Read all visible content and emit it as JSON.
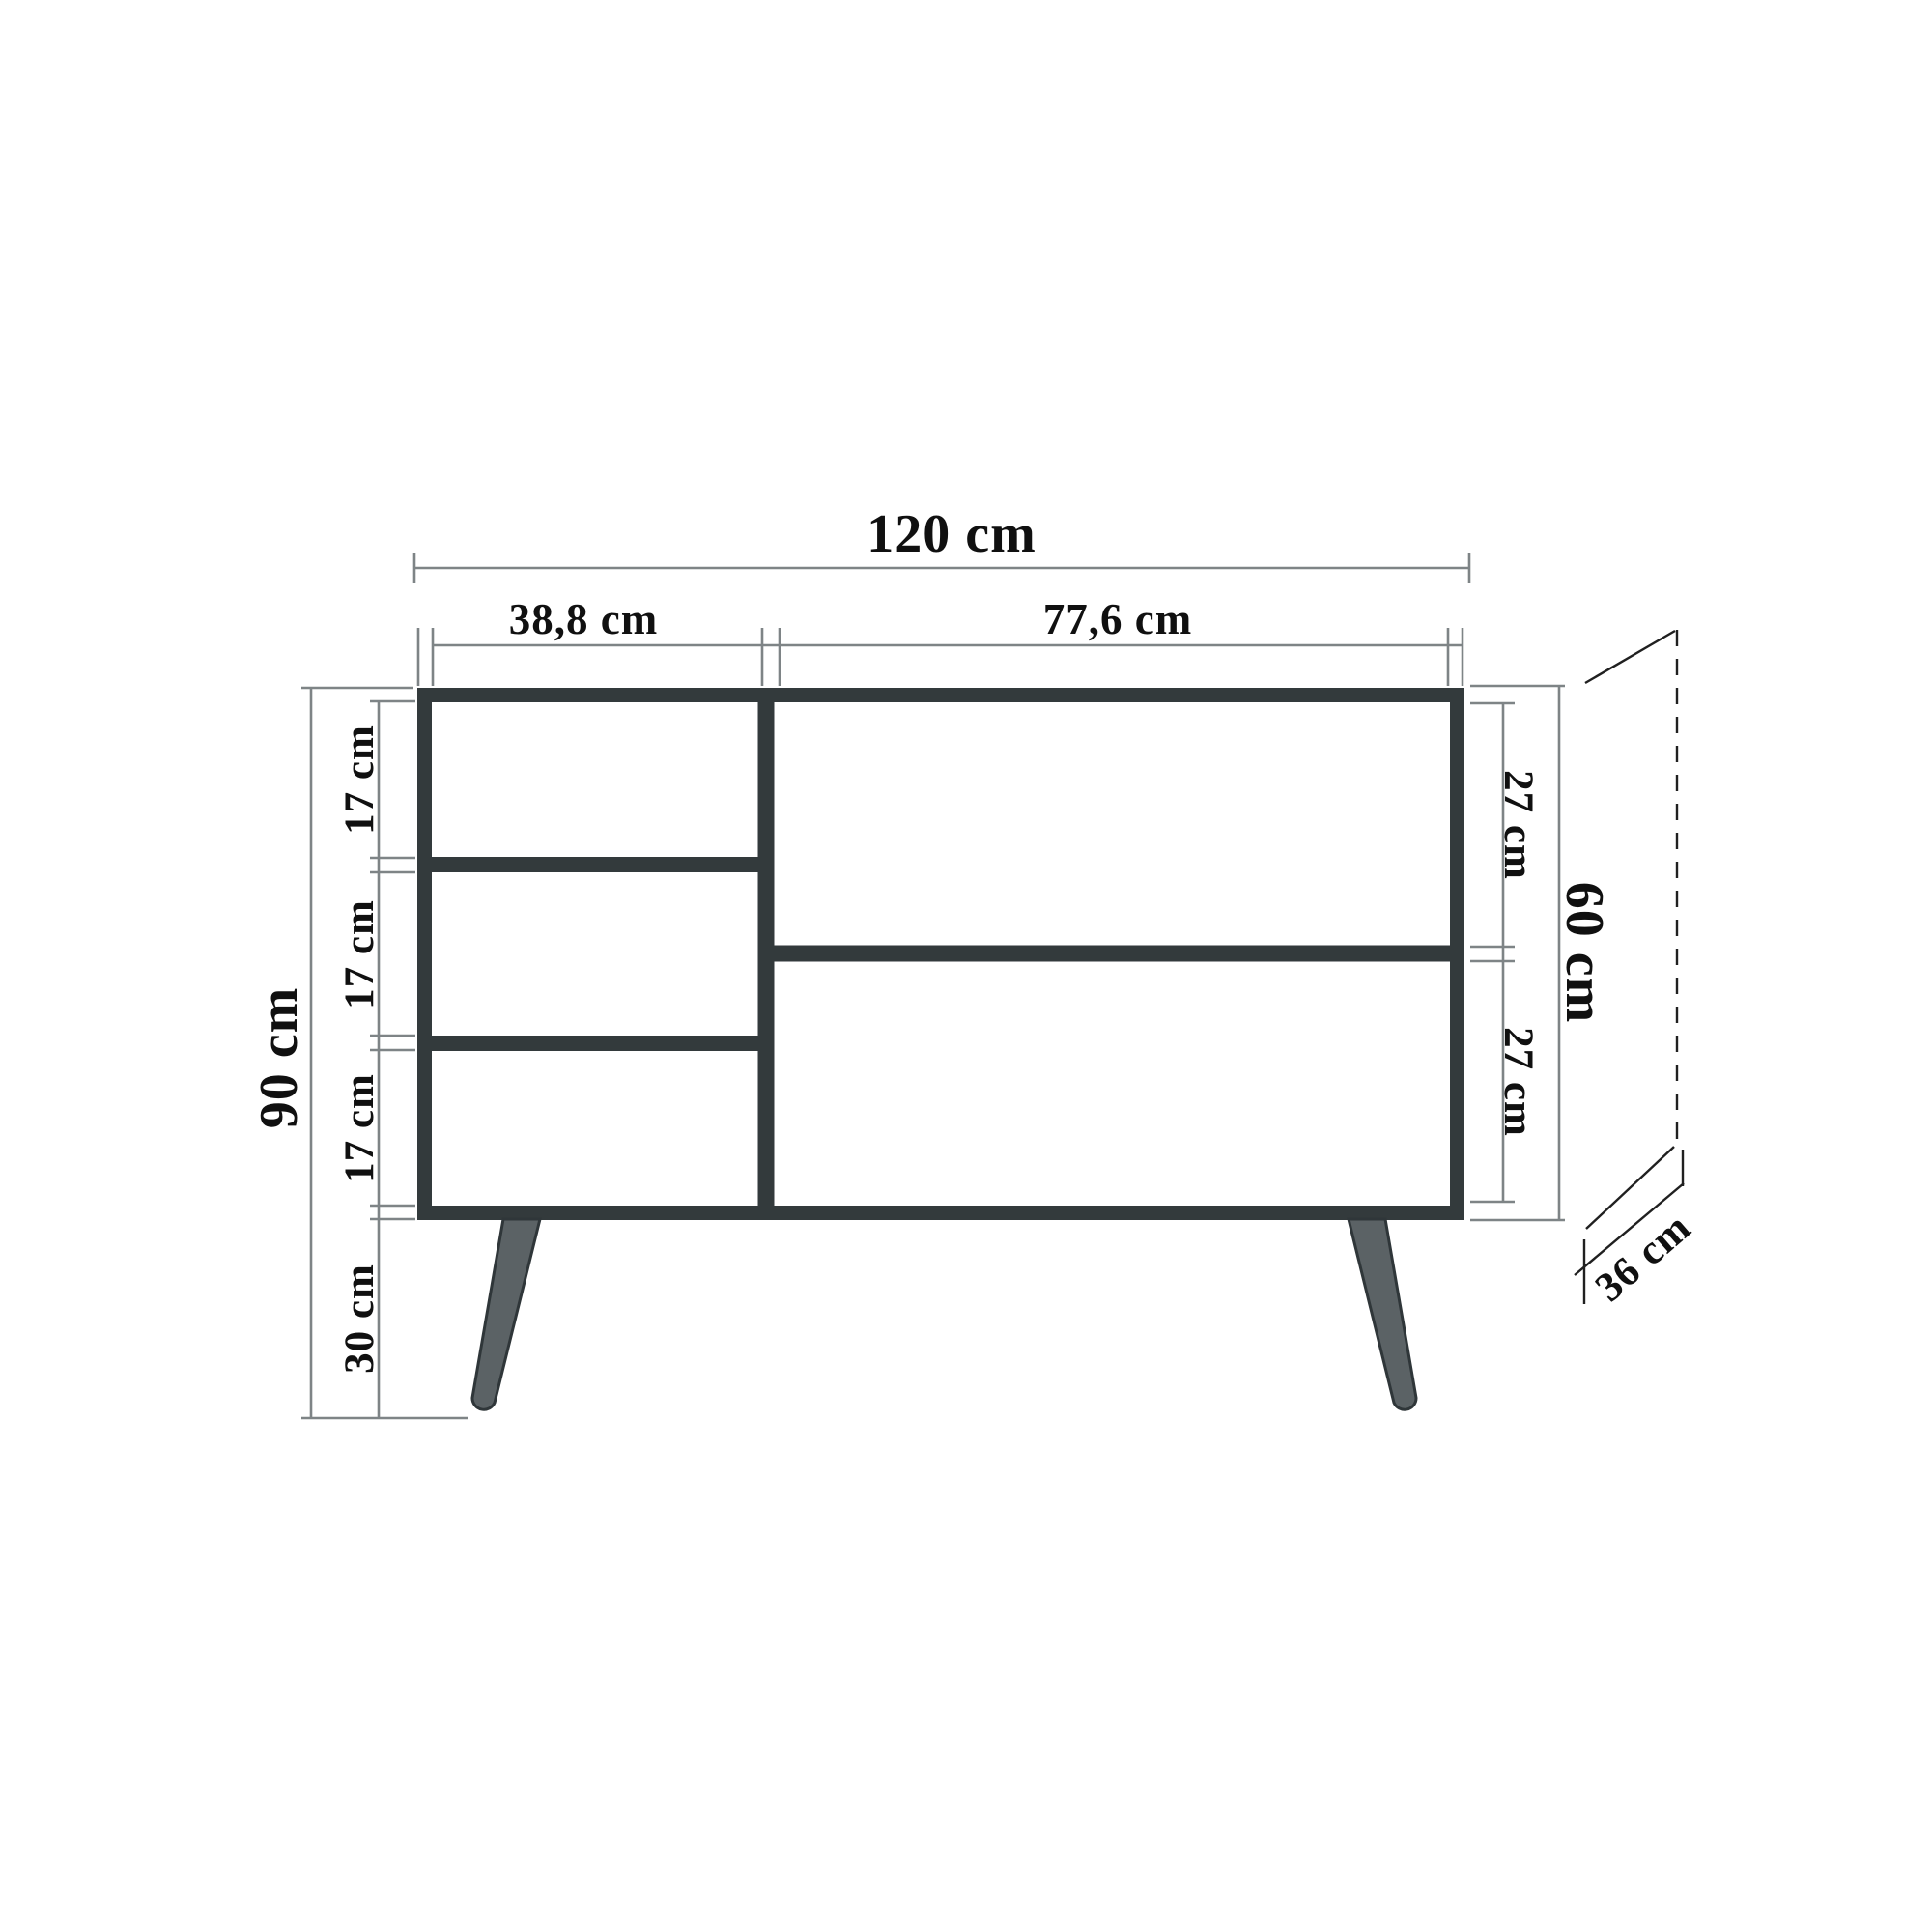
{
  "diagram": {
    "kind": "furniture-dimension-drawing",
    "view": "front elevation of sideboard with angled legs and depth projection",
    "unit": "cm",
    "labels": {
      "total_width": "120 cm",
      "left_column_width": "38,8 cm",
      "right_column_width": "77,6 cm",
      "overall_height": "90 cm",
      "left_compartment_1": "17 cm",
      "left_compartment_2": "17 cm",
      "left_compartment_3": "17 cm",
      "leg_height": "30 cm",
      "right_compartment_top": "27 cm",
      "right_compartment_bottom": "27 cm",
      "body_height": "60 cm",
      "depth": "36 cm"
    },
    "values": {
      "total_width_cm": 120,
      "left_column_width_cm": 38.8,
      "right_column_width_cm": 77.6,
      "overall_height_cm": 90,
      "left_compartment_cm": 17,
      "leg_height_cm": 30,
      "right_compartment_cm": 27,
      "body_height_cm": 60,
      "depth_cm": 36
    },
    "colors": {
      "background": "#ffffff",
      "cabinet_stroke": "#333a3c",
      "leg_fill": "#5b6265",
      "dimension_line": "#7e8486",
      "projection_line": "#202020",
      "text": "#101010"
    }
  }
}
